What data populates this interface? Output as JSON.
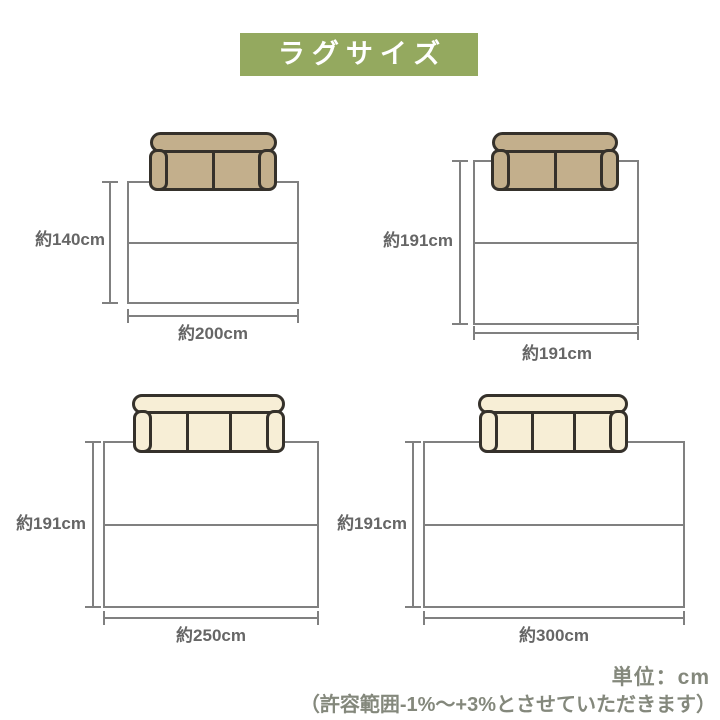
{
  "banner": {
    "label": "ラグサイズ"
  },
  "diagrams": [
    {
      "name": "rug-140x200",
      "height_label": "約140cm",
      "width_label": "約200cm",
      "sofa_icon": "two-seat-sofa",
      "sofa_color": "#C3AF8C"
    },
    {
      "name": "rug-191x191",
      "height_label": "約191cm",
      "width_label": "約191cm",
      "sofa_icon": "two-seat-sofa",
      "sofa_color": "#C3AF8C"
    },
    {
      "name": "rug-191x250",
      "height_label": "約191cm",
      "width_label": "約250cm",
      "sofa_icon": "three-seat-sofa",
      "sofa_color": "#F7EED6"
    },
    {
      "name": "rug-191x300",
      "height_label": "約191cm",
      "width_label": "約300cm",
      "sofa_icon": "three-seat-sofa",
      "sofa_color": "#F7EED6"
    }
  ],
  "footer": {
    "unit_label": "単位：cm",
    "tolerance_note": "（許容範囲-1%〜+3%とさせていただきます）"
  },
  "colors": {
    "banner_bg": "#94A95F",
    "banner_text": "#FFFFFF",
    "line_gray": "#808080",
    "dim_label_text": "#666666",
    "note_text": "#84887C",
    "sofa_outline": "#35312B",
    "sofa_tan": "#C3AF8C",
    "sofa_cream": "#F7EED6"
  }
}
